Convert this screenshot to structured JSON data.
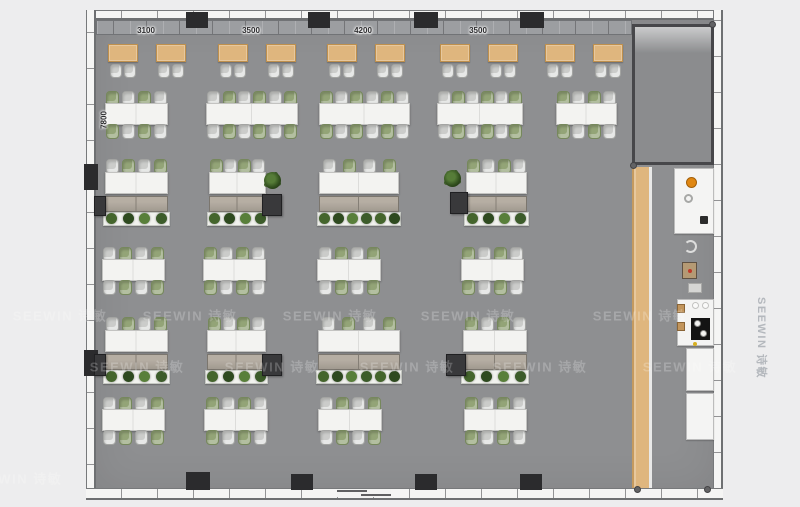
{
  "watermark": {
    "text": "SEEWIN 诗敏",
    "horizontal": [
      [
        60,
        315
      ],
      [
        190,
        315
      ],
      [
        330,
        315
      ],
      [
        468,
        315
      ],
      [
        640,
        315
      ],
      [
        137,
        366
      ],
      [
        272,
        366
      ],
      [
        407,
        366
      ],
      [
        540,
        366
      ],
      [
        690,
        366
      ],
      [
        15,
        478
      ]
    ],
    "vertical": [
      762,
      338
    ]
  },
  "dimensions": {
    "top_labels": [
      {
        "text": "3100"
      },
      {
        "text": "3500"
      },
      {
        "text": "4200"
      },
      {
        "text": "3500"
      }
    ],
    "left_label": {
      "text": "7800"
    }
  },
  "colors": {
    "floor": "#8e8f91",
    "wood": "#dfb67e",
    "chair_green": "#93a477",
    "chair_gray": "#cbccca",
    "accent_orange": "#e08712",
    "page_background": "#ededee",
    "plant_palette": [
      "#44652c",
      "#2e4a1f",
      "#587f3a",
      "#3c5c2a"
    ]
  },
  "furniture": {
    "coffee_tables": {
      "y": 44,
      "xs": [
        108,
        156,
        218,
        266,
        327,
        375,
        440,
        488,
        545,
        593
      ]
    },
    "double_desks": [
      {
        "x": 105,
        "y": 91,
        "w": 63,
        "seats": 4
      },
      {
        "x": 206,
        "y": 91,
        "w": 92,
        "seats": 6
      },
      {
        "x": 319,
        "y": 91,
        "w": 91,
        "seats": 6
      },
      {
        "x": 437,
        "y": 91,
        "w": 86,
        "seats": 6
      },
      {
        "x": 556,
        "y": 91,
        "w": 61,
        "seats": 4
      },
      {
        "x": 102,
        "y": 247,
        "w": 63,
        "seats": 4
      },
      {
        "x": 203,
        "y": 247,
        "w": 63,
        "seats": 4
      },
      {
        "x": 317,
        "y": 247,
        "w": 64,
        "seats": 4
      },
      {
        "x": 461,
        "y": 247,
        "w": 63,
        "seats": 4
      },
      {
        "x": 102,
        "y": 397,
        "w": 63,
        "seats": 4
      },
      {
        "x": 204,
        "y": 397,
        "w": 64,
        "seats": 4
      },
      {
        "x": 318,
        "y": 397,
        "w": 64,
        "seats": 4
      },
      {
        "x": 464,
        "y": 397,
        "w": 63,
        "seats": 4
      }
    ],
    "single_desks": [
      {
        "x": 105,
        "y": 159,
        "w": 63,
        "seats": 4,
        "plants": 4
      },
      {
        "x": 209,
        "y": 159,
        "w": 57,
        "seats": 4,
        "plants": 4
      },
      {
        "x": 319,
        "y": 159,
        "w": 80,
        "seats": 4,
        "plants": 6
      },
      {
        "x": 466,
        "y": 159,
        "w": 61,
        "seats": 4,
        "plants": 4
      },
      {
        "x": 105,
        "y": 317,
        "w": 63,
        "seats": 4,
        "plants": 4
      },
      {
        "x": 207,
        "y": 317,
        "w": 59,
        "seats": 4,
        "plants": 4
      },
      {
        "x": 318,
        "y": 317,
        "w": 82,
        "seats": 4,
        "plants": 6
      },
      {
        "x": 463,
        "y": 317,
        "w": 64,
        "seats": 4,
        "plants": 4
      }
    ],
    "plants": [
      [
        264,
        172
      ],
      [
        444,
        170
      ]
    ]
  },
  "structure": {
    "columns": [
      [
        186,
        12,
        22,
        16
      ],
      [
        308,
        12,
        22,
        16
      ],
      [
        414,
        12,
        24,
        16
      ],
      [
        520,
        12,
        24,
        16
      ],
      [
        186,
        472,
        24,
        18
      ],
      [
        291,
        474,
        22,
        16
      ],
      [
        415,
        474,
        22,
        16
      ],
      [
        520,
        474,
        22,
        16
      ],
      [
        84,
        164,
        14,
        26
      ],
      [
        84,
        350,
        14,
        26
      ]
    ],
    "pillars": [
      [
        94,
        196,
        12,
        20
      ],
      [
        262,
        194,
        20,
        22
      ],
      [
        450,
        192,
        18,
        22
      ],
      [
        94,
        354,
        12,
        22
      ],
      [
        262,
        354,
        20,
        22
      ],
      [
        446,
        354,
        20,
        22
      ]
    ],
    "corner_dots": [
      [
        630,
        162
      ],
      [
        709,
        21
      ],
      [
        634,
        486
      ],
      [
        704,
        486
      ]
    ]
  }
}
